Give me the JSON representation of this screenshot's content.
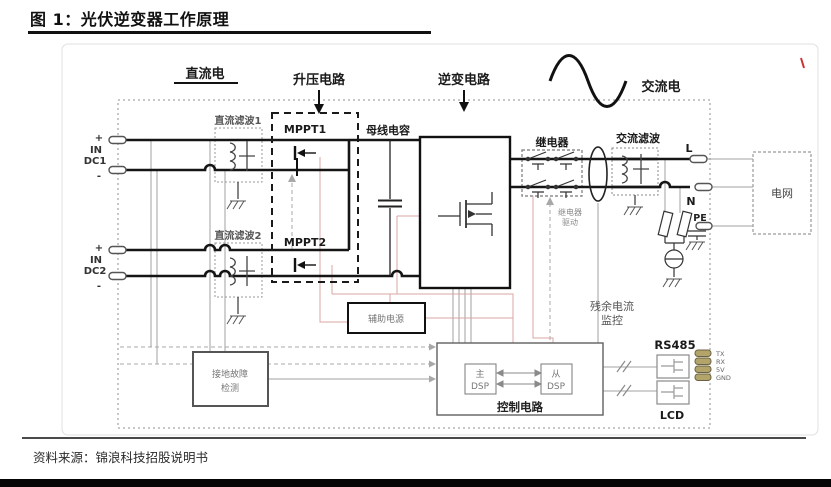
{
  "page": {
    "title": "图 1：光伏逆变器工作原理",
    "source": "资料来源：锦浪科技招股说明书"
  },
  "sections": {
    "dc": "直流电",
    "boost": "升压电路",
    "inverter": "逆变电路",
    "ac": "交流电"
  },
  "blocks": {
    "dc_filter1": "直流滤波1",
    "dc_filter2": "直流滤波2",
    "mppt1": "MPPT1",
    "mppt2": "MPPT2",
    "bus_cap": "母线电容",
    "relay": "继电器",
    "relay_drive_l1": "继电器",
    "relay_drive_l2": "驱动",
    "ac_filter": "交流滤波",
    "grid": "电网",
    "aux_power": "辅助电源",
    "ground_fault_l1": "接地故障",
    "ground_fault_l2": "检测",
    "residual_l1": "残余电流",
    "residual_l2": "监控",
    "control": "控制电路",
    "main_dsp_l1": "主",
    "main_dsp_l2": "DSP",
    "slave_dsp_l1": "从",
    "slave_dsp_l2": "DSP"
  },
  "terminals": {
    "plus": "+",
    "minus": "-",
    "in_label": "IN",
    "dc1": "DC1",
    "dc2": "DC2",
    "l": "L",
    "n": "N",
    "pe": "PE"
  },
  "io": {
    "rs485": "RS485",
    "lcd": "LCD",
    "tx": "TX",
    "rx": "RX",
    "v5": "5V",
    "gnd": "GND"
  },
  "colors": {
    "wire": "#1a1a1a",
    "signal_gray": "#9a9a9a",
    "signal_pink": "#dba5a5",
    "terminal_fill": "#b3a469",
    "accent_red": "#cc3333"
  }
}
